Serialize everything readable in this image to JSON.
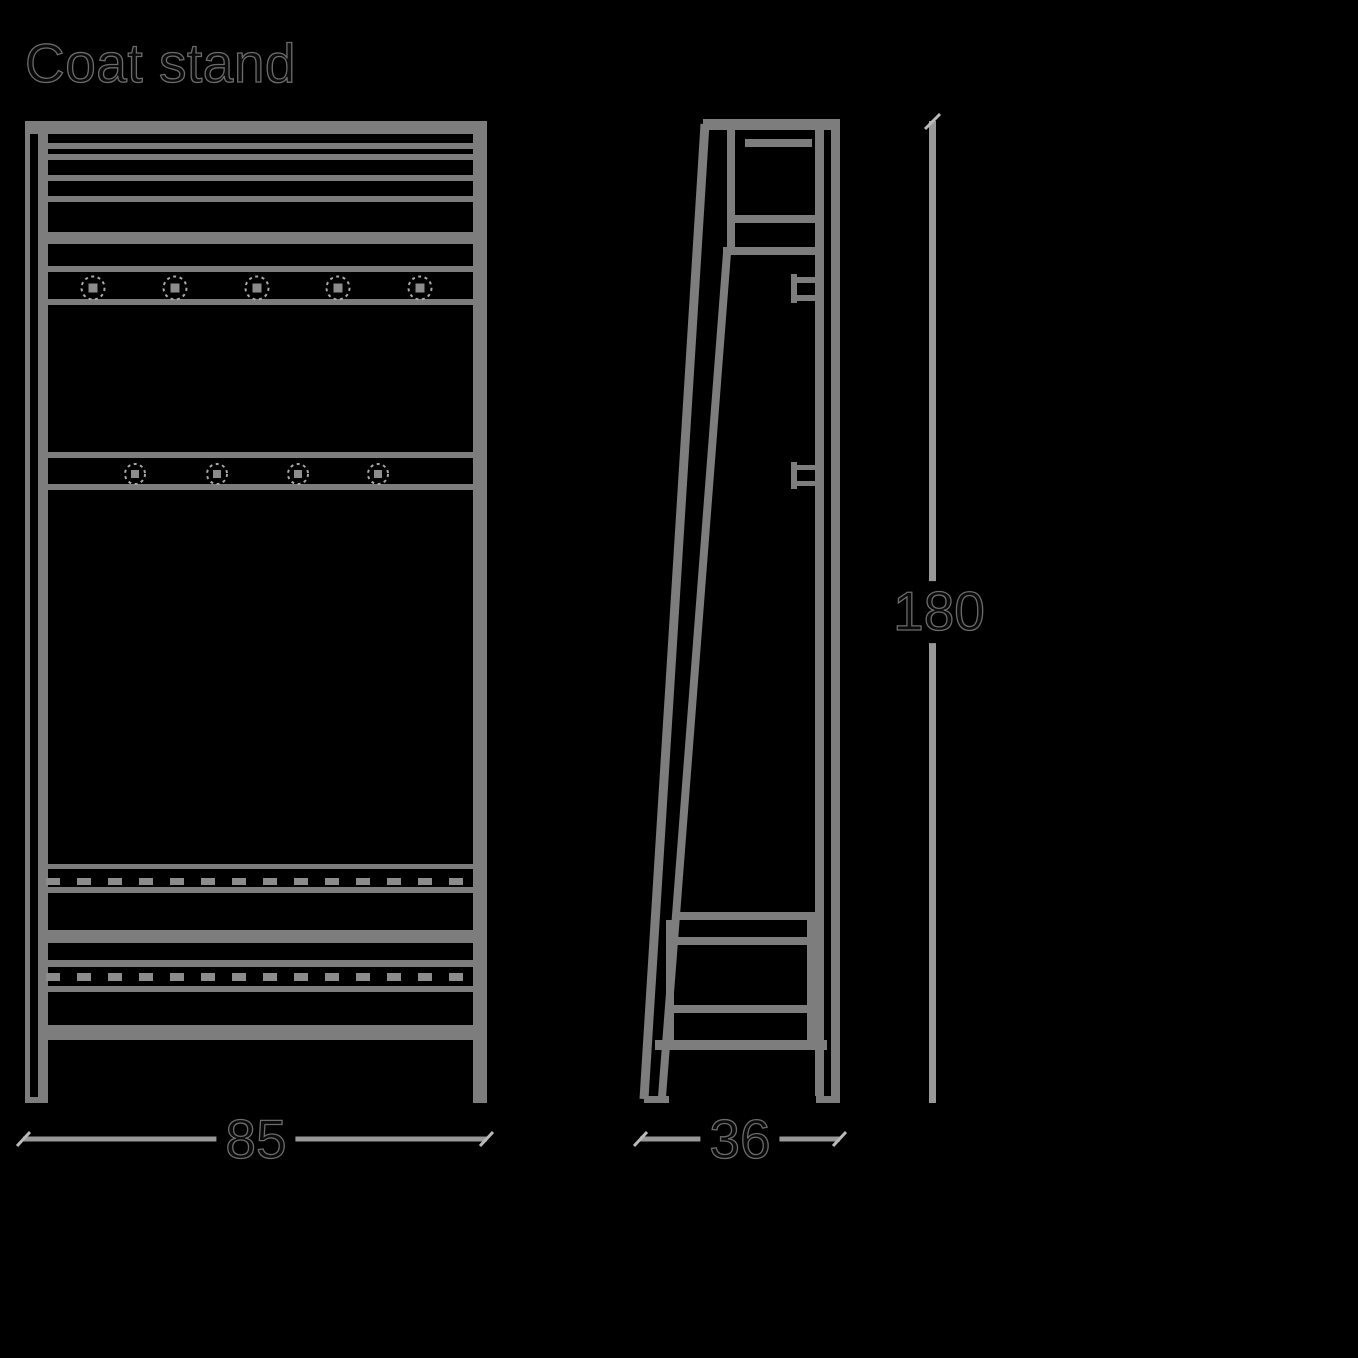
{
  "title": "Coat stand",
  "dimensions": {
    "width": {
      "value": "85"
    },
    "depth": {
      "value": "36"
    },
    "height": {
      "value": "180"
    }
  },
  "figure": {
    "front_view": {
      "hook_row_1_count": 5,
      "hook_row_2_count": 4
    },
    "side_view": {
      "hook_count": 2
    }
  },
  "colors": {
    "background": "#000000",
    "line": "#7d7d7d",
    "line_light": "#8c8c8c",
    "dim_line": "#989898",
    "tick": "#b9b9b9",
    "hook_dash": "#a8a8a8",
    "label": "#0a0a0a",
    "label_outline": "#6b6b6b"
  }
}
